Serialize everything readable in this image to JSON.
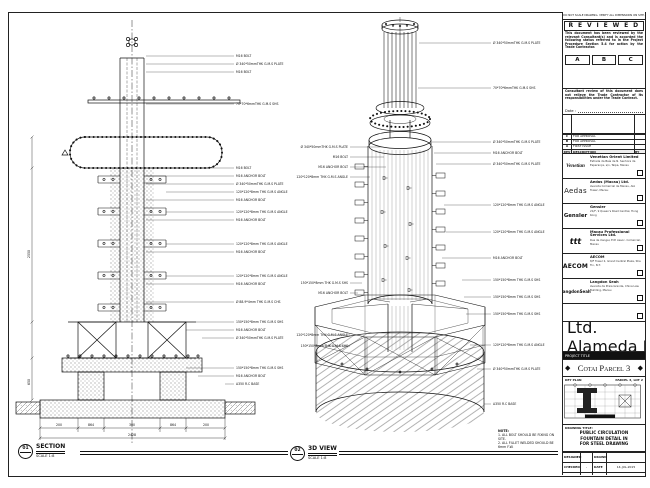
{
  "sheet": {
    "views": [
      {
        "num": "01",
        "name": "SECTION",
        "scale": "SCALE 1:8"
      },
      {
        "num": "02",
        "name": "3D VIEW",
        "scale": "SCALE 1:8"
      }
    ],
    "note": {
      "title": "NOTE:",
      "lines": [
        "1. ALL BOLT SHOULD BE FIXING ON SITE.",
        "2. ALL FILLET WELDED SHOULD BE 6mm F.W."
      ]
    }
  },
  "section": {
    "labels": [
      {
        "t": "M16 BOLT"
      },
      {
        "t": "Ø 340*50mmTHK G.M.S PLATE"
      },
      {
        "t": "M16 BOLT"
      },
      {
        "t": "70*70*6mmTHK G.M.S SHS"
      },
      {
        "t": "M16 BOLT"
      },
      {
        "t": "M16 ANCHOR BOLT"
      },
      {
        "t": "Ø 340*50mmTHK G.M.S PLATE"
      },
      {
        "t": "120*120*8mm THK G.M.S ANGLE"
      },
      {
        "t": "M16 ANCHOR BOLT"
      },
      {
        "t": "120*120*8mm THK G.M.S ANGLE"
      },
      {
        "t": "M16 ANCHOR BOLT"
      },
      {
        "t": "120*120*8mm THK G.M.S ANGLE"
      },
      {
        "t": "M16 ANCHOR BOLT"
      },
      {
        "t": "120*120*8mm THK G.M.S ANGLE"
      },
      {
        "t": "M16 ANCHOR BOLT"
      },
      {
        "t": "Ø 88.9*4mm THK G.M.S CHS"
      },
      {
        "t": "150*150*8mm THK G.M.S SHS"
      },
      {
        "t": "M16 ANCHOR BOLT"
      },
      {
        "t": "Ø 340*50mmTHK G.M.S PLATE"
      },
      {
        "t": "150*150*8mm THK G.M.S SHS"
      },
      {
        "t": "M16 ANCHOR BOLT"
      },
      {
        "t": "A350 R.C BASE"
      }
    ],
    "dims": {
      "segs": [
        "200",
        "864",
        "300",
        "864",
        "200"
      ],
      "total": "2428",
      "v1": "2550",
      "v2": "650"
    }
  },
  "three_d": {
    "right": [
      {
        "t": "Ø 340*50mmTHK G.M.S PLATE"
      },
      {
        "t": "70*70*6mmTHK G.M.S SHS"
      },
      {
        "t": "Ø 340*50mmTHK G.M.S PLATE"
      },
      {
        "t": "M16 ANCHOR BOLT"
      },
      {
        "t": "Ø 340*50mmTHK G.M.S PLATE"
      },
      {
        "t": "120*120*8mm THK G.M.S ANGLE"
      },
      {
        "t": "120*120*8mm THK G.M.S ANGLE"
      },
      {
        "t": "M16 ANCHOR BOLT"
      },
      {
        "t": "150*150*8mm THK G.M.S SHS"
      },
      {
        "t": "150*150*8mm THK G.M.S SHS"
      },
      {
        "t": "150*150*8mm THK G.M.S SHS"
      },
      {
        "t": "120*120*8mm THK G.M.S ANGLE"
      },
      {
        "t": "Ø 340*50mmTHK G.M.S PLATE"
      },
      {
        "t": "A350 R.C BASE"
      }
    ],
    "left": [
      {
        "t": "Ø 340*50mmTHK G.M.S PLATE"
      },
      {
        "t": "M16 BOLT"
      },
      {
        "t": "M16 ANCHOR BOLT"
      },
      {
        "t": "120*120*8mm THK G.M.S ANGLE"
      },
      {
        "t": "150*150*8mm THK G.M.S SHS"
      },
      {
        "t": "M16 ANCHOR BOLT"
      },
      {
        "t": "120*120*8mm THK G.M.S ANGLE"
      },
      {
        "t": "150*150*8mm THK G.M.S SHS"
      }
    ]
  },
  "titleblock": {
    "top_note": "DO NOT SCALE DRAWING. VERIFY ALL DIMENSIONS ON SITE.",
    "reviewed": {
      "title": "R E V I E W E D",
      "para1": "This document has been reviewed by the relevant Consultant(s) and is accorded the following status referred to in the Project Procedure Section 5.4 for action by the Trade Contractor.",
      "statuses": [
        "A",
        "B",
        "C"
      ],
      "para2": "Consultant review of this document does not relieve the Trade Contractor of its responsibilities under the Trade Contract.",
      "date_label": "Date :"
    },
    "revisions": {
      "header": [
        "REV",
        "DATE",
        "DESCRIPTION",
        "BY"
      ],
      "rows": [
        {
          "rev": "C",
          "desc": "FOR APPROVAL"
        },
        {
          "rev": "B",
          "desc": "FOR APPROVAL"
        },
        {
          "rev": "A",
          "desc": "FIRST ISSUE"
        }
      ]
    },
    "companies": [
      {
        "logo": "Venetian",
        "name": "Venetian Orient Limited",
        "addr": "Estrada da Baía de N. Senhora da Esperança, s/n, Taipa, Macau"
      },
      {
        "logo": "Aedas",
        "name": "Aedas (Macau) Ltd.",
        "addr": "Avenida Comercial de Macau, AIA Tower, Macau"
      },
      {
        "logo": "Gensler",
        "name": "Gensler",
        "addr": "21/F, 9 Queen's Road Central, Hong Kong"
      },
      {
        "logo": "ttt",
        "name": "Macau Professional Services Ltd.",
        "addr": "Rua de Xangai, Edf. Assoc. Comercial, Macau"
      },
      {
        "logo": "AECOM",
        "name": "AECOM",
        "addr": "8/F Tower 2, Grand Central Plaza, Sha Tin, N.T."
      },
      {
        "logo": "LangdonSeah",
        "name": "Langdon Seah",
        "addr": "Avenida da Praia Grande, China Law Building, Macau"
      }
    ],
    "contractor": {
      "name": "Hsin Chong Construction (Macau) Co., Ltd.",
      "addr": "Alameda Dr. Carlos D'Assumpção, Macau"
    },
    "project": {
      "label": "PROJECT TITLE",
      "title": "Cotai Parcel 3",
      "ornament": "◆"
    },
    "key_plan": {
      "label": "KEY PLAN",
      "right": "PARCEL 3, LOT 2"
    },
    "drawing_title": {
      "label": "DRAWING TITLE:",
      "lines": [
        "PUBLIC CIRCULATION",
        "FOUNTAIN DETAIL IN",
        "FOR STEEL DRAWING"
      ]
    },
    "info": {
      "r1l": "DESIGNED",
      "r1v": "",
      "r1l2": "DRAWN",
      "r1v2": "",
      "r2l": "CHECKED",
      "r2v": "-",
      "r2l2": "DATE",
      "r2v2": "14-JUL-2015",
      "r3l": "APPROVED",
      "r3v": "-",
      "r3l2": "SCALE",
      "r3v2": "AS SHOWN",
      "dwg_label": "DWG NO",
      "dwg_no": "S-YUS_PS_8001",
      "rev_label": "REV",
      "rev": "C",
      "cad_label": "CAD FILE NAME",
      "cad": "S-YUS_PS_8001.dwg",
      "ref_label": "REFERENCE",
      "ref": ""
    }
  }
}
